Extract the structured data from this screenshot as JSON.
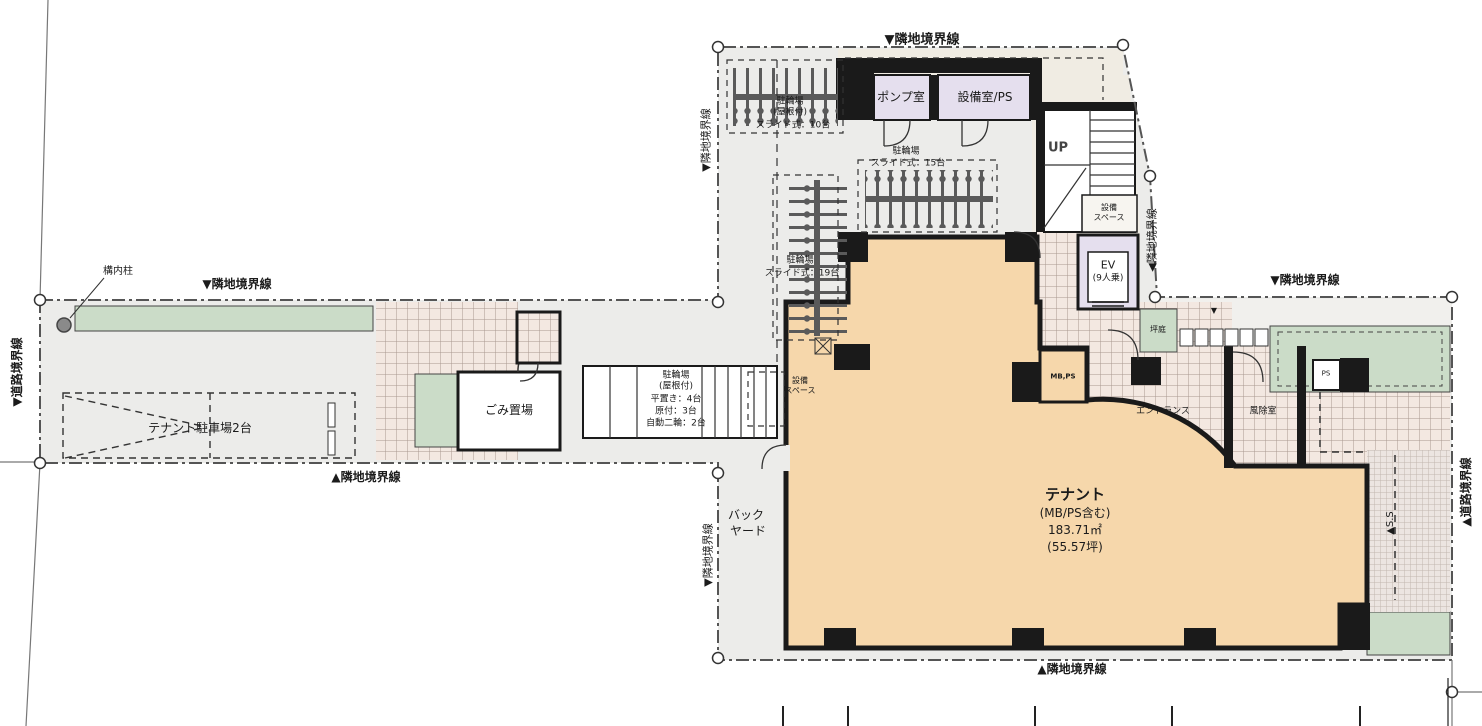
{
  "boundaries": {
    "top_upper": "▼隣地境界線",
    "top_west": "▼隣地境界線",
    "top_right": "▼隣地境界線",
    "bottom_west": "▲隣地境界線",
    "bottom_main": "▲隣地境界線",
    "left_upper_side": "▼隣地境界線",
    "right_upper_side": "◀隣地境界線",
    "backyard_side": "▼隣地境界線",
    "road_left": "▼道路境界線",
    "road_right": "▲道路境界線"
  },
  "rooms": {
    "pump": "ポンプ室",
    "equipment": "設備室/PS",
    "stair_up": "UP",
    "equip_space_l1": "設備",
    "equip_space_l2": "スペース",
    "equip_space2_l1": "設備",
    "equip_space2_l2": "スペース",
    "ev_l1": "EV",
    "ev_l2": "(9人乗)",
    "garbage": "ごみ置場",
    "backyard_l1": "バック",
    "backyard_l2": "ヤード",
    "entrance": "エントランス",
    "windbreak": "風除室",
    "ps": "PS",
    "mb_ps": "MB,PS",
    "garden": "坪庭",
    "grade_marker": "▼",
    "ss": "▲S.S"
  },
  "tenant": {
    "l1": "テナント",
    "l2": "(MB/PS含む)",
    "l3": "183.71㎡",
    "l4": "(55.57坪)"
  },
  "bicycle": {
    "b10_l1": "駐輪場",
    "b10_l2": "(屋根付)",
    "b10_l3": "スライド式：10台",
    "b15_l1": "駐輪場",
    "b15_l2": "スライド式：15台",
    "b19_l1": "駐輪場",
    "b19_l2": "スライド式：19台",
    "west_l1": "駐輪場",
    "west_l2": "(屋根付)",
    "west_l3": "平置き：4台",
    "west_l4": "原付：3台",
    "west_l5": "自動二輪：2台"
  },
  "site": {
    "pillar": "構内柱",
    "tenant_parking": "テナント駐車場2台"
  },
  "colors": {
    "tenant_fill": "#f6d7ab",
    "room_fill": "#e5dfee",
    "green_fill": "#cbdcc8",
    "site_fill": "#ececea",
    "tile_fill": "#f3e8e1",
    "wall": "#1a1a1a"
  }
}
